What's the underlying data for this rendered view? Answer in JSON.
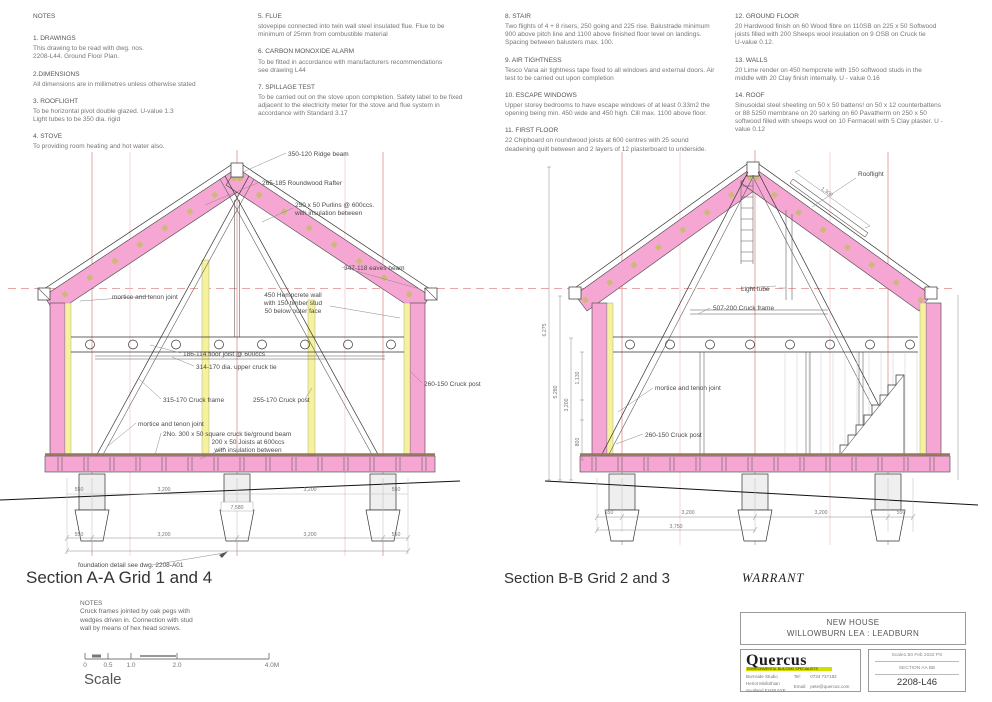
{
  "notes": [
    {
      "title": "NOTES",
      "items": [
        {
          "h": "1. DRAWINGS",
          "b": "This drawing to be read with dwg. nos.\n2208-L44.  Ground Floor Plan."
        },
        {
          "h": "2.DIMENSIONS",
          "b": "All dimensions are in millimetres unless otherwise stated"
        },
        {
          "h": "3. ROOFLIGHT",
          "b": "To be horizontal pivot double glazed.  U-value 1.3\nLight tubes to be 350 dia. rigid"
        },
        {
          "h": "4. STOVE",
          "b": "To providing room heating and hot water also."
        }
      ]
    },
    {
      "title": "",
      "items": [
        {
          "h": "5. FLUE",
          "b": "stovepipe connected into twin wall steel insulated flue. Flue to be\nminimum of 25mm from combustible material"
        },
        {
          "h": "6. CARBON MONOXIDE ALARM",
          "b": "To be fitted in accordance with manufacturers recommendations\nsee drawing L44"
        },
        {
          "h": "7. SPILLAGE TEST",
          "b": "To be carried out on the stove upon completion. Safety label to be fixed\nadjacent to the electricity meter for the stove and flue system in\naccordance with Standard 3.17"
        }
      ]
    },
    {
      "title": "",
      "items": [
        {
          "h": "8. STAIR",
          "b": "Two flights of 4 + 8 risers, 250 going and 225 rise. Balustrade minimum\n900 above pitch line and 1100 above finished floor level on landings.\nSpacing between balusters max. 100."
        },
        {
          "h": "9. AIR TIGHTNESS",
          "b": "Tesco Vana air tightness tape fixed to all windows and external doors. Air\ntest to be carried out upon completion"
        },
        {
          "h": "10. ESCAPE WINDOWS",
          "b": "Upper storey bedrooms to have escape windows of at least 0.33m2 the\nopening being min. 450 wide and 450 high. Cill max. 1100 above floor."
        },
        {
          "h": "11. FIRST FLOOR",
          "b": "22 Chipboard on roundwood joists at 600 centres with 25 sound\ndeadening quilt between and 2 layers of 12 plasterboard to underside."
        }
      ]
    },
    {
      "title": "",
      "items": [
        {
          "h": "12. GROUND FLOOR",
          "b": "20 Hardwood finish on 60 Wood fibre on 110SB on 225 x 50 Softwood\njoists filled with 200 Sheeps wool insulation on 9 OSB on Cruck tie\nU-value 0.12."
        },
        {
          "h": "13. WALLS",
          "b": "20 Lime render  on 450 hempcrete with 150 softwood studs in the\nmiddle with 20 Clay finish internally. U -  value 0.16"
        },
        {
          "h": "14. ROOF",
          "b": "Sinusoidal steel sheeting on 50 x 50 battens! on 50 x 12 counterbattens\nor 88 5250 membrane on 20 sarking on 60 Pavatherm on 250 x 50\nsoftwood filled with sheeps wool on 10 Fermacell with 5 Clay plaster. U -\nvalue 0.12"
        }
      ]
    }
  ],
  "sectionA": {
    "title": "Section A-A  Grid 1 and 4",
    "labels": {
      "ridge_beam": "350-120 Ridge beam",
      "rafter": "265-185 Roundwood Rafter",
      "purlins1": "250 x 50 Purlins @ 600ccs.",
      "purlins2": "with insulation between",
      "eaves_beam": "347-118 eaves beam",
      "mortice_upper": "mortice and tenon joint",
      "hemp1": "450 Hempcrete wall",
      "hemp2": "with 150 timber stud",
      "hemp3": "50 below outer face",
      "floor_joist": "186-114 floor joist @ 600ccs",
      "upper_cruck_tie": "314-170 dia. upper cruck tie",
      "cruck_frame": "315-170 Cruck frame",
      "cruck_post": "255-170 Cruck post",
      "cruck_post_right": "260-150 Cruck post",
      "mortice_lower": "mortice and tenon joint",
      "ground_beam": "2No. 300 x 50 square cruck tie/ground beam",
      "joists1": "200 x 50 Joists at 600ccs",
      "joists2": "with insulation between",
      "foundation_note": "foundation detail see dwg. 2208-A01"
    },
    "dims": {
      "row": [
        "550",
        "3,200",
        "3,200",
        "550"
      ],
      "mid": "7,580"
    }
  },
  "sectionB": {
    "title": "Section B-B Grid 2 and 3",
    "labels": {
      "rooflight": "Rooflight",
      "light_tube": "Light tube",
      "cruck_frame": "507-200 Cruck frame",
      "mortice": "mortice and tenon joint",
      "cruck_post": "260-150 Cruck post"
    },
    "dims": {
      "row": [
        "550",
        "3,200",
        "3,200",
        "550"
      ],
      "partial": "3,750",
      "rooflight": "1,300",
      "vert": [
        "6,275",
        "5,280",
        "3,200",
        "1,130",
        "800"
      ]
    }
  },
  "warrant": "WARRANT",
  "bottom_notes": {
    "title": "NOTES",
    "body": "Cruck frames jointed by oak pegs with\nwedges driven in. Connection with stud\nwall by means of hex head screws."
  },
  "scale_bar": {
    "ticks": [
      "0",
      "0.5",
      "1.0",
      "2.0",
      "4.0M"
    ],
    "label": "Scale"
  },
  "title_block": {
    "project1": "NEW HOUSE",
    "project2": "WILLOWBURN LEA : LEADBURN",
    "logo": {
      "name": "Quercus",
      "tagline": "ENVIRONMENTAL BUILDING SPECIALISTS",
      "addr1": "Burnside Studio",
      "addr2": "Heriot   Midlothian",
      "addr3": "Scotland EH38 5YE",
      "tel_label": "Tel:",
      "tel": "0734 737182",
      "email_label": "Email:",
      "email": "pete@quercus.com"
    },
    "info_row1": "Scale1:50   Feb 2022   PS",
    "info_row2": "SECTION AA  BB",
    "drawing_no": "2208-L46"
  }
}
